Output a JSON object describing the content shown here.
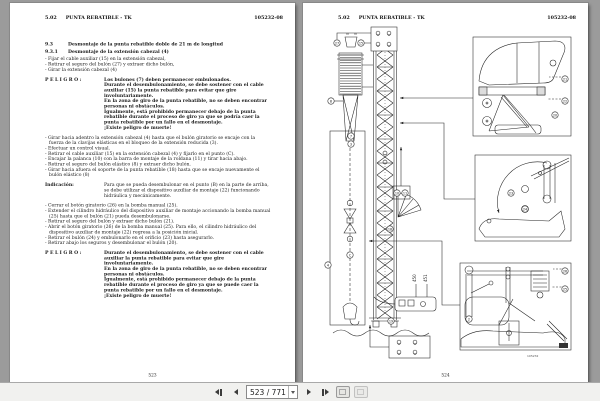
{
  "viewer": {
    "background_color": "#9b9b9b",
    "toolbar": {
      "page_field_value": "523 / 771",
      "icons": [
        "first-page-icon",
        "previous-page-icon",
        "page-number-dropdown",
        "next-page-icon",
        "last-page-icon",
        "previous-view-icon",
        "next-view-icon"
      ]
    }
  },
  "left_page": {
    "header": {
      "section": "5.02",
      "title": "PUNTA REBATIBLE - TK",
      "doc_number": "105232-08"
    },
    "blocks": [
      {
        "type": "heading",
        "num": "9.3",
        "text": "Desmontaje de la punta rebatible doble de 21 m de longitud"
      },
      {
        "type": "heading",
        "num": "9.3.1",
        "text": "Desmontaje de la extensión cabezal (4)"
      },
      {
        "type": "bullets",
        "items": [
          "Fijar el cable auxiliar (15) en la extensión cabezal,",
          "Retirar el seguro del bulón (27) y extraer dicho bulón,",
          "Girar la extensión cabezal (4)"
        ]
      },
      {
        "type": "danger",
        "label": "PELIGRO:",
        "lines": [
          "Los bulones (7) deben permanecer embulonados.",
          "Durante el desembulonamiento, se debe sostener con el cable auxiliar (15) la punta rebatible  para evitar que gire involuntariamente.",
          "En la zona de giro de la punta rebatible, no se deben encontrar personas ni obstáculos.",
          "Igualmente, está prohibido permanecer debajo de la punta rebatible durante el proceso de giro ya que se podría caer la punta rebatible por un fallo en el desmontaje.",
          "¡Existe peligro de muerte!"
        ]
      },
      {
        "type": "bullets",
        "items": [
          "Girar hacia adentro la extensión cabezal (4) hasta que el bulón giratorio se encaje con la fuerza de la clavijas elásticas en el bloqueo de la extensión reducida (3).",
          "Efectuar un control visual.",
          "Retirar el cable auxiliar (15) en la extensión cabezal (4) y fijarlo en el punto (C).",
          "Encajar la palanca (10) con la barra de montaje de la roldana (11) y tirar hacia abajo.",
          "Retirar el seguro del bulón elástico (8) y extraer dicho bulón.",
          "Girar hacia afuera el soporte de la punta rebatible (18) hasta que se encaje nuevamente el bulón elástico (8)"
        ]
      },
      {
        "type": "note",
        "label": "Indicación:",
        "lines": [
          "Para que se pueda desembulonar en el punto (B) en la parte de arriba, se debe utilizar el dispositivo auxiliar de montaje (22) funcionando hidráulica y mecánicamente."
        ]
      },
      {
        "type": "bullets",
        "items": [
          "Cerrar el botón giratorio (26) en la bomba manual (25).",
          "Extender el cilindro hidráulico del dispositivo auxiliar de montaje accionando la bomba manual (25) hasta que el bulón (21) pueda desembulonarse.",
          "Retirar el seguro del bulón y extraer dicho bulón (21).",
          "Abrir el botón giratorio (26) de la bomba manual (25). Para ello, el cilindro hidráulico del dispositivo auxiliar de montaje (22) regresa a la posición inicial.",
          "Retirar el bulón (24) y embulonarlo en el orificio (23) hasta asegurarlo.",
          "Retirar abajo los seguros y desembulonar el bulón (20)."
        ]
      },
      {
        "type": "danger",
        "label": "PELIGRO:",
        "lines": [
          "Durante el desembulonamiento, se debe sostener con el cable auxiliar la punta rebatible  para evitar que gire involuntariamente.",
          "En la zona de giro de la punta rebatible, no se deben encontrar personas ni obstáculos.",
          "Igualmente, está prohibido permanecer debajo de la punta rebatible durante el proceso de giro ya que se puede caer la punta rebatible por un fallo en el desmontaje.",
          "¡Existe peligro de muerte!"
        ]
      }
    ],
    "footer_page_number": "523"
  },
  "right_page": {
    "header": {
      "section": "5.02",
      "title": "PUNTA REBATIBLE - TK",
      "doc_number": "105232-08"
    },
    "figure": {
      "machine_labels": [
        "450",
        "451"
      ],
      "caption": "105232",
      "callouts": [
        {
          "label": "27",
          "x": 34,
          "y": 40
        },
        {
          "label": "15",
          "x": 58,
          "y": 40
        },
        {
          "label": "8",
          "x": 28,
          "y": 98
        },
        {
          "label": "7",
          "x": 48,
          "y": 133
        },
        {
          "label": "3",
          "x": 48,
          "y": 141
        },
        {
          "label": "10",
          "x": 94,
          "y": 190
        },
        {
          "label": "11",
          "x": 102,
          "y": 190
        },
        {
          "label": "18",
          "x": 87,
          "y": 226
        },
        {
          "label": "4",
          "x": 25,
          "y": 262
        },
        {
          "label": "C",
          "x": 47,
          "y": 252
        },
        {
          "label": "19",
          "x": 88,
          "y": 318
        },
        {
          "label": "21",
          "x": 262,
          "y": 76
        },
        {
          "label": "22",
          "x": 262,
          "y": 98
        },
        {
          "label": "20",
          "x": 252,
          "y": 112
        },
        {
          "label": "23",
          "x": 208,
          "y": 190
        },
        {
          "label": "24",
          "x": 222,
          "y": 206
        },
        {
          "label": "26",
          "x": 262,
          "y": 268
        },
        {
          "label": "25",
          "x": 262,
          "y": 286
        },
        {
          "label": "2",
          "x": 166,
          "y": 316
        }
      ]
    },
    "footer_page_number": "524"
  }
}
